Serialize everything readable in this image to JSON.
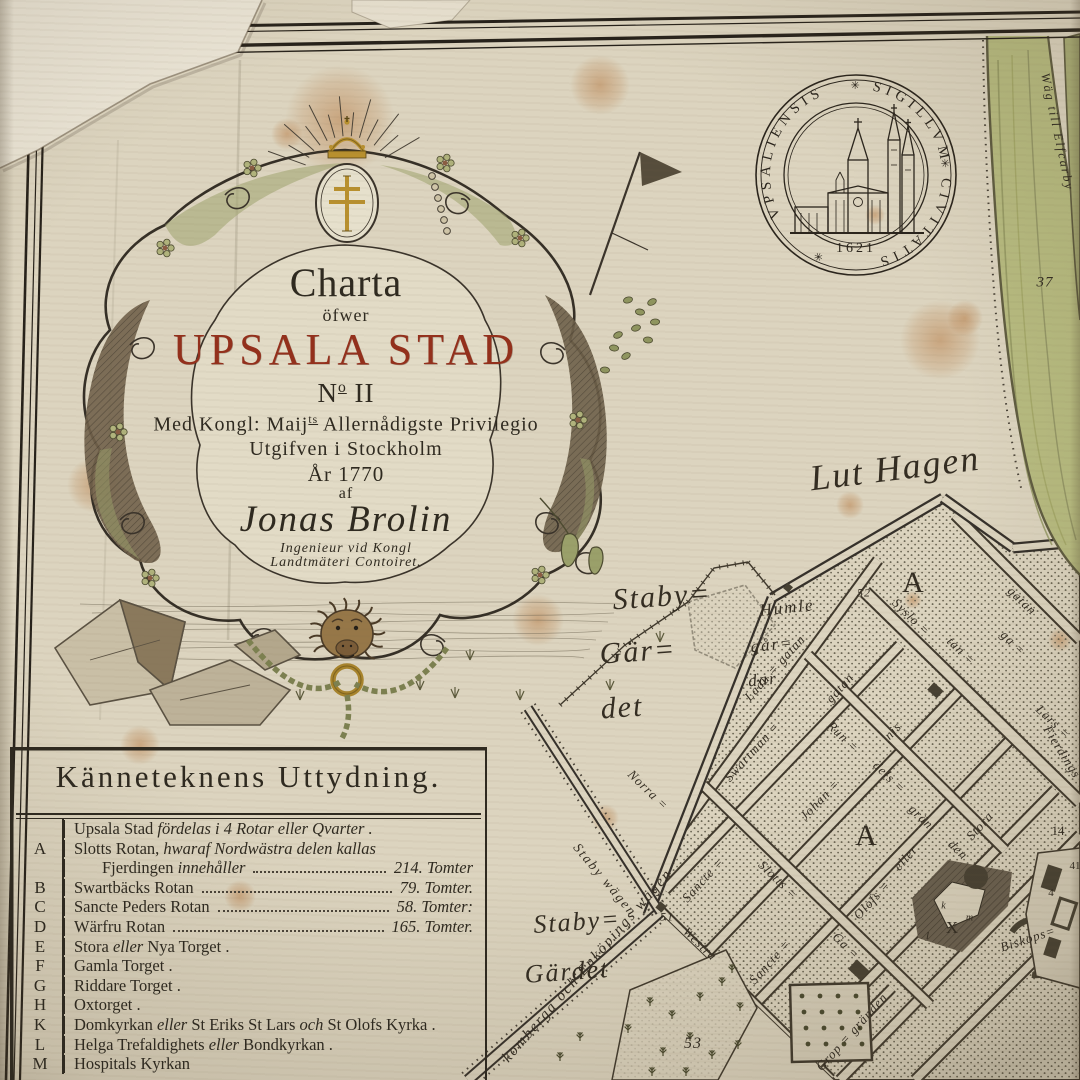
{
  "cartouche": {
    "line1": "Charta",
    "line2": "öfwer",
    "title": "UPSALA STAD",
    "no_n": "N",
    "no_sup": "o",
    "no_rest": " II",
    "priv1": "Med Kongl: Maij",
    "priv_sup": "ts",
    "priv2": " Allernådigste Privilegio",
    "published": "Utgifven i Stockholm",
    "year": "År 1770",
    "af": "af",
    "author": "Jonas Brolin",
    "author_title1": "Ingenieur vid Kongl",
    "author_title2": "Landtmäteri Contoiret."
  },
  "seal": {
    "word1": "VPSALIENSIS",
    "word2": "SIGILLVM",
    "word3": "CIVITATIS",
    "rosette": "✳",
    "year": "1621"
  },
  "legend": {
    "title": "Känneteknens Uttydning.",
    "rows": [
      {
        "key": "",
        "segs": [
          {
            "t": "Upsala Stad ",
            "i": 0
          },
          {
            "t": "fördelas i 4 Rotar eller Qvarter .",
            "i": 1
          }
        ]
      },
      {
        "key": "A",
        "segs": [
          {
            "t": "Slotts Rotan, ",
            "i": 0
          },
          {
            "t": "hwaraf Nordwästra delen kallas",
            "i": 1
          }
        ]
      },
      {
        "key": "",
        "ind": 1,
        "segs": [
          {
            "t": "Fjerdingen ",
            "i": 0
          },
          {
            "t": "innehåller",
            "i": 1
          }
        ],
        "value": "214. Tomter"
      },
      {
        "key": "B",
        "segs": [
          {
            "t": "Swartbäcks Rotan",
            "i": 0
          }
        ],
        "value": "79. Tomter."
      },
      {
        "key": "C",
        "segs": [
          {
            "t": "Sancte Peders Rotan",
            "i": 0
          }
        ],
        "value": "58. Tomter:"
      },
      {
        "key": "D",
        "segs": [
          {
            "t": "Wärfru Rotan",
            "i": 0
          }
        ],
        "value": "165. Tomter."
      },
      {
        "key": "E",
        "segs": [
          {
            "t": "Stora ",
            "i": 0
          },
          {
            "t": "eller",
            "i": 1
          },
          {
            "t": " Nya Torget .",
            "i": 0
          }
        ]
      },
      {
        "key": "F",
        "segs": [
          {
            "t": "Gamla Torget .",
            "i": 0
          }
        ]
      },
      {
        "key": "G",
        "segs": [
          {
            "t": "Riddare Torget .",
            "i": 0
          }
        ]
      },
      {
        "key": "H",
        "segs": [
          {
            "t": "Oxtorget .",
            "i": 0
          }
        ]
      },
      {
        "key": "K",
        "segs": [
          {
            "t": "Domkyrkan ",
            "i": 0
          },
          {
            "t": "eller",
            "i": 1
          },
          {
            "t": " St Eriks St Lars ",
            "i": 0
          },
          {
            "t": "och",
            "i": 1
          },
          {
            "t": " St Olofs Kyrka .",
            "i": 0
          }
        ]
      },
      {
        "key": "L",
        "segs": [
          {
            "t": "Helga Trefaldighets ",
            "i": 0
          },
          {
            "t": "eller",
            "i": 1
          },
          {
            "t": " Bondkyrkan .",
            "i": 0
          }
        ]
      },
      {
        "key": "M",
        "segs": [
          {
            "t": "Hospitals Kyrkan",
            "i": 0
          }
        ]
      }
    ]
  },
  "map": {
    "script_labels": [
      {
        "text": "Lut Hagen",
        "x": 895,
        "y": 468,
        "rot": -7,
        "size": 36
      },
      {
        "text": "Staby=",
        "x": 662,
        "y": 597,
        "rot": -4,
        "size": 30
      },
      {
        "text": "Gär=",
        "x": 638,
        "y": 652,
        "rot": -4,
        "size": 30
      },
      {
        "text": "det",
        "x": 622,
        "y": 708,
        "rot": -4,
        "size": 30
      },
      {
        "text": "Staby=",
        "x": 577,
        "y": 922,
        "rot": -4,
        "size": 26
      },
      {
        "text": "Gärdet",
        "x": 567,
        "y": 972,
        "rot": -4,
        "size": 26
      },
      {
        "text": "Humle",
        "x": 787,
        "y": 608,
        "rot": -6,
        "size": 17
      },
      {
        "text": "går=",
        "x": 772,
        "y": 645,
        "rot": -6,
        "size": 17
      },
      {
        "text": "dar",
        "x": 763,
        "y": 680,
        "rot": -6,
        "size": 17
      },
      {
        "text": "Wäg till Elfcarby",
        "x": 1057,
        "y": 132,
        "rot": 78,
        "size": 12.5
      },
      {
        "text": "Staby wägen",
        "x": 605,
        "y": 880,
        "rot": 50,
        "size": 13.5
      },
      {
        "text": "komberga och Enköpings wägen",
        "x": 588,
        "y": 966,
        "rot": -49,
        "size": 15
      }
    ],
    "street_labels": [
      {
        "text": "Ladu = gatan",
        "x": 775,
        "y": 668,
        "rot": -48
      },
      {
        "text": "gatan",
        "x": 840,
        "y": 688,
        "rot": -48
      },
      {
        "text": "Swartman =",
        "x": 752,
        "y": 752,
        "rot": -48
      },
      {
        "text": "Johan =",
        "x": 820,
        "y": 800,
        "rot": -46
      },
      {
        "text": "nis",
        "x": 893,
        "y": 731,
        "rot": -46
      },
      {
        "text": "Run =",
        "x": 843,
        "y": 737,
        "rot": 44
      },
      {
        "text": "dels =",
        "x": 889,
        "y": 777,
        "rot": 44
      },
      {
        "text": "grän",
        "x": 921,
        "y": 817,
        "rot": 44
      },
      {
        "text": "Syslo =",
        "x": 911,
        "y": 617,
        "rot": 44
      },
      {
        "text": "tan =",
        "x": 961,
        "y": 651,
        "rot": 44
      },
      {
        "text": "ga =",
        "x": 1013,
        "y": 643,
        "rot": 44
      },
      {
        "text": "gatan",
        "x": 1022,
        "y": 601,
        "rot": 44
      },
      {
        "text": "Lars =",
        "x": 1053,
        "y": 722,
        "rot": 44
      },
      {
        "text": "Fierdings",
        "x": 1062,
        "y": 752,
        "rot": 58
      },
      {
        "text": "Stora",
        "x": 980,
        "y": 826,
        "rot": -48
      },
      {
        "text": "den",
        "x": 958,
        "y": 850,
        "rot": 44
      },
      {
        "text": "Olofs =",
        "x": 872,
        "y": 900,
        "rot": -48
      },
      {
        "text": "eller",
        "x": 906,
        "y": 858,
        "rot": -48
      },
      {
        "text": "Sancte =",
        "x": 703,
        "y": 880,
        "rot": -48
      },
      {
        "text": "Slotts =",
        "x": 778,
        "y": 880,
        "rot": 44
      },
      {
        "text": "Sancte =",
        "x": 770,
        "y": 962,
        "rot": -48
      },
      {
        "text": "Ga =",
        "x": 846,
        "y": 946,
        "rot": 44
      },
      {
        "text": "Grop = gränden",
        "x": 852,
        "y": 1032,
        "rot": -48
      },
      {
        "text": "Biskops=",
        "x": 1028,
        "y": 939,
        "rot": -18
      },
      {
        "text": "Westra",
        "x": 700,
        "y": 944,
        "rot": 44
      },
      {
        "text": "Norra =",
        "x": 648,
        "y": 790,
        "rot": 44
      }
    ],
    "marks": [
      {
        "text": "37",
        "x": 1045,
        "y": 283,
        "size": 15,
        "it": 1
      },
      {
        "text": "52",
        "x": 864,
        "y": 593,
        "size": 12,
        "it": 1
      },
      {
        "text": "51",
        "x": 667,
        "y": 917,
        "size": 12,
        "it": 1
      },
      {
        "text": "53",
        "x": 693,
        "y": 1044,
        "size": 16,
        "it": 1
      },
      {
        "text": "14",
        "x": 1058,
        "y": 831,
        "size": 13,
        "it": 0
      },
      {
        "text": "41",
        "x": 1075,
        "y": 866,
        "size": 11,
        "it": 0
      },
      {
        "text": "4",
        "x": 1051,
        "y": 893,
        "size": 11,
        "it": 0
      },
      {
        "text": "A",
        "x": 913,
        "y": 583,
        "size": 30,
        "it": 0
      },
      {
        "text": "A",
        "x": 866,
        "y": 836,
        "size": 30,
        "it": 0
      },
      {
        "text": "X",
        "x": 952,
        "y": 928,
        "size": 17,
        "it": 0
      },
      {
        "text": "k",
        "x": 944,
        "y": 906,
        "size": 10,
        "it": 1
      },
      {
        "text": "l",
        "x": 928,
        "y": 936,
        "size": 11,
        "it": 1
      },
      {
        "text": "m",
        "x": 970,
        "y": 918,
        "size": 10,
        "it": 1
      }
    ]
  },
  "colors": {
    "paper": "#dcd4bf",
    "ink": "#2f2a20",
    "title_red": "#93301c",
    "gold": "#b8902e",
    "river": "#b7bb80",
    "river_dark": "#5f5c40",
    "stipple": "#55503f",
    "stain": "#b97f4a"
  }
}
